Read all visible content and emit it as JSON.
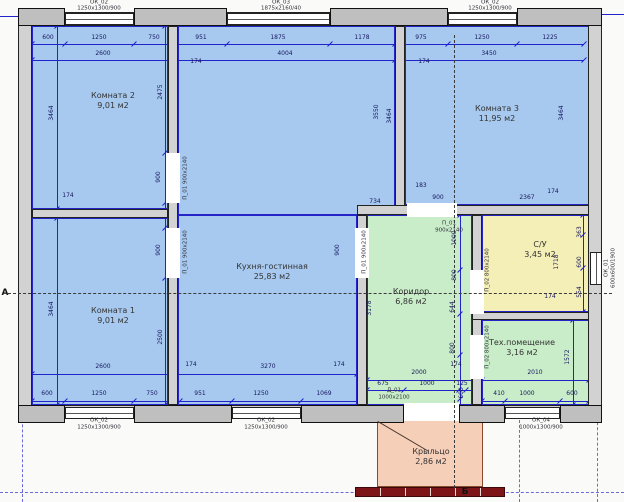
{
  "title": "Поэтажный план дома",
  "colors": {
    "blue": "#a7c9ef",
    "green": "#c9edc9",
    "yellow": "#f4efb6",
    "porch": "#f6cfb8",
    "wall": "#d2d2d2",
    "accent_line": "#2323cc",
    "steps": "#7d1518"
  },
  "plan": {
    "rooms": [
      {
        "id": "komnata-2",
        "name": "Комната 2",
        "area": "9,01 м2",
        "color": "blue",
        "lx": 113,
        "ly": 101,
        "rects": [
          [
            32,
            26,
            136,
            183
          ]
        ]
      },
      {
        "id": "komnata-1",
        "name": "Комната 1",
        "area": "9,01 м2",
        "color": "blue",
        "lx": 113,
        "ly": 316,
        "rects": [
          [
            32,
            218,
            136,
            187
          ]
        ]
      },
      {
        "id": "kuhnya-gostinnaya",
        "name": "Кухня-гостинная",
        "area": "25,83 м2",
        "color": "blue",
        "lx": 272,
        "ly": 272,
        "rects": [
          [
            178,
            26,
            217,
            189
          ],
          [
            178,
            215,
            179,
            190
          ]
        ]
      },
      {
        "id": "komnata-3",
        "name": "Комната 3",
        "area": "11,95 м2",
        "color": "blue",
        "lx": 497,
        "ly": 114,
        "rects": [
          [
            405,
            26,
            184,
            179
          ]
        ]
      },
      {
        "id": "koridor",
        "name": "Коридор",
        "area": "6,86 м2",
        "color": "green",
        "lx": 411,
        "ly": 297,
        "rects": [
          [
            367,
            215,
            105,
            190
          ]
        ]
      },
      {
        "id": "su",
        "name": "С/У",
        "area": "3,45 м2",
        "color": "yellow",
        "lx": 540,
        "ly": 250,
        "rects": [
          [
            482,
            215,
            107,
            97
          ]
        ]
      },
      {
        "id": "tehpomeschenie",
        "name": "Тех.помещение",
        "area": "3,16 м2",
        "color": "green",
        "lx": 522,
        "ly": 348,
        "rects": [
          [
            482,
            320,
            107,
            85
          ]
        ]
      },
      {
        "id": "krylco",
        "name": "Крыльцо",
        "area": "2,86 м2",
        "color": "porch",
        "lx": 431,
        "ly": 457,
        "rects": [
          [
            377,
            419,
            106,
            68
          ]
        ]
      }
    ],
    "walls": [
      [
        18,
        12,
        584,
        14
      ],
      [
        18,
        405,
        584,
        14
      ],
      [
        18,
        12,
        14,
        407
      ],
      [
        588,
        12,
        14,
        407
      ],
      [
        168,
        26,
        10,
        379
      ],
      [
        32,
        209,
        136,
        9
      ],
      [
        395,
        26,
        10,
        189
      ],
      [
        357,
        205,
        232,
        10
      ],
      [
        357,
        215,
        10,
        190
      ],
      [
        472,
        215,
        10,
        190
      ],
      [
        472,
        312,
        117,
        8
      ]
    ],
    "piers": [
      [
        18,
        8,
        47,
        18
      ],
      [
        134,
        8,
        93,
        18
      ],
      [
        330,
        8,
        118,
        18
      ],
      [
        517,
        8,
        85,
        18
      ],
      [
        18,
        405,
        47,
        18
      ],
      [
        134,
        405,
        98,
        18
      ],
      [
        301,
        405,
        103,
        18
      ],
      [
        459,
        405,
        46,
        18
      ],
      [
        560,
        405,
        42,
        18
      ]
    ],
    "gaps": [
      [
        166,
        153,
        14,
        50
      ],
      [
        166,
        228,
        14,
        50
      ],
      [
        407,
        203,
        50,
        14
      ],
      [
        355,
        228,
        14,
        50
      ],
      [
        470,
        270,
        14,
        44
      ],
      [
        470,
        335,
        14,
        44
      ],
      [
        404,
        403,
        55,
        18
      ]
    ],
    "windows": [
      {
        "r": [
          65,
          13,
          69,
          12
        ],
        "o": "h"
      },
      {
        "r": [
          227,
          13,
          103,
          12
        ],
        "o": "h"
      },
      {
        "r": [
          448,
          13,
          69,
          12
        ],
        "o": "h"
      },
      {
        "r": [
          65,
          407,
          69,
          12
        ],
        "o": "h"
      },
      {
        "r": [
          232,
          407,
          69,
          12
        ],
        "o": "h"
      },
      {
        "r": [
          505,
          407,
          55,
          12
        ],
        "o": "h"
      },
      {
        "r": [
          590,
          252,
          12,
          33
        ],
        "o": "v"
      }
    ],
    "dimlines": [
      {
        "o": "h",
        "x": 32,
        "y": 44,
        "len": 552,
        "ticks": [
          32,
          65,
          134,
          175,
          227,
          330,
          395,
          448,
          517,
          584
        ]
      },
      {
        "o": "h",
        "x": 32,
        "y": 60,
        "len": 552,
        "ticks": [
          32,
          175,
          395,
          584
        ]
      },
      {
        "o": "h",
        "x": 32,
        "y": 374,
        "len": 325,
        "ticks": [
          32,
          175,
          357
        ]
      },
      {
        "o": "h",
        "x": 32,
        "y": 401,
        "len": 328,
        "ticks": [
          32,
          65,
          134,
          175,
          180,
          232,
          301,
          360
        ]
      },
      {
        "o": "h",
        "x": 360,
        "y": 380,
        "len": 120,
        "ticks": [
          367,
          477
        ]
      },
      {
        "o": "h",
        "x": 367,
        "y": 390,
        "len": 105,
        "ticks": [
          367,
          404,
          459,
          466
        ]
      },
      {
        "o": "h",
        "x": 482,
        "y": 380,
        "len": 107,
        "ticks": [
          482,
          589
        ]
      },
      {
        "o": "h",
        "x": 482,
        "y": 401,
        "len": 107,
        "ticks": [
          482,
          505,
          560,
          589
        ]
      },
      {
        "o": "v",
        "x": 57,
        "y": 26,
        "len": 379,
        "ticks": [
          26,
          209,
          218,
          405
        ]
      },
      {
        "o": "v",
        "x": 165,
        "y": 26,
        "len": 379,
        "ticks": [
          26,
          153,
          203,
          228,
          278,
          405
        ]
      },
      {
        "o": "v",
        "x": 460,
        "y": 215,
        "len": 190,
        "ticks": [
          215,
          270,
          314,
          355,
          399
        ]
      },
      {
        "o": "v",
        "x": 583,
        "y": 215,
        "len": 97,
        "ticks": [
          215,
          235,
          268,
          312
        ]
      },
      {
        "o": "v",
        "x": 573,
        "y": 320,
        "len": 85,
        "ticks": [
          320,
          405
        ]
      }
    ],
    "labels": [
      {
        "t": "600",
        "x": 48,
        "y": 38,
        "c": "d"
      },
      {
        "t": "1250",
        "x": 99,
        "y": 38,
        "c": "d"
      },
      {
        "t": "750",
        "x": 154,
        "y": 38,
        "c": "d"
      },
      {
        "t": "951",
        "x": 201,
        "y": 38,
        "c": "d"
      },
      {
        "t": "1875",
        "x": 278,
        "y": 38,
        "c": "d"
      },
      {
        "t": "1178",
        "x": 362,
        "y": 38,
        "c": "d"
      },
      {
        "t": "975",
        "x": 421,
        "y": 38,
        "c": "d"
      },
      {
        "t": "1250",
        "x": 482,
        "y": 38,
        "c": "d"
      },
      {
        "t": "1225",
        "x": 550,
        "y": 38,
        "c": "d"
      },
      {
        "t": "2600",
        "x": 103,
        "y": 54,
        "c": "d"
      },
      {
        "t": "4004",
        "x": 285,
        "y": 54,
        "c": "d"
      },
      {
        "t": "3450",
        "x": 489,
        "y": 54,
        "c": "d"
      },
      {
        "t": "2600",
        "x": 103,
        "y": 367,
        "c": "d"
      },
      {
        "t": "3270",
        "x": 268,
        "y": 367,
        "c": "d"
      },
      {
        "t": "2000",
        "x": 419,
        "y": 373,
        "c": "d"
      },
      {
        "t": "2010",
        "x": 535,
        "y": 373,
        "c": "d"
      },
      {
        "t": "675",
        "x": 383,
        "y": 384,
        "c": "d"
      },
      {
        "t": "1000",
        "x": 427,
        "y": 384,
        "c": "d"
      },
      {
        "t": "125",
        "x": 462,
        "y": 384,
        "c": "d"
      },
      {
        "t": "600",
        "x": 47,
        "y": 394,
        "c": "d"
      },
      {
        "t": "1250",
        "x": 99,
        "y": 394,
        "c": "d"
      },
      {
        "t": "750",
        "x": 152,
        "y": 394,
        "c": "d"
      },
      {
        "t": "951",
        "x": 200,
        "y": 394,
        "c": "d"
      },
      {
        "t": "1250",
        "x": 261,
        "y": 394,
        "c": "d"
      },
      {
        "t": "1069",
        "x": 324,
        "y": 394,
        "c": "d"
      },
      {
        "t": "410",
        "x": 499,
        "y": 394,
        "c": "d"
      },
      {
        "t": "1000",
        "x": 527,
        "y": 394,
        "c": "d"
      },
      {
        "t": "600",
        "x": 572,
        "y": 394,
        "c": "d"
      },
      {
        "t": "174",
        "x": 196,
        "y": 62,
        "c": "d"
      },
      {
        "t": "174",
        "x": 424,
        "y": 62,
        "c": "d"
      },
      {
        "t": "174",
        "x": 68,
        "y": 196,
        "c": "d"
      },
      {
        "t": "174",
        "x": 553,
        "y": 192,
        "c": "d"
      },
      {
        "t": "174",
        "x": 550,
        "y": 297,
        "c": "d"
      },
      {
        "t": "174",
        "x": 191,
        "y": 365,
        "c": "d"
      },
      {
        "t": "174",
        "x": 339,
        "y": 365,
        "c": "d"
      },
      {
        "t": "174",
        "x": 456,
        "y": 365,
        "c": "d"
      },
      {
        "t": "183",
        "x": 421,
        "y": 186,
        "c": "d"
      },
      {
        "t": "900",
        "x": 438,
        "y": 198,
        "c": "d"
      },
      {
        "t": "2367",
        "x": 527,
        "y": 198,
        "c": "d"
      },
      {
        "t": "734",
        "x": 375,
        "y": 202,
        "c": "d"
      },
      {
        "t": "3464",
        "x": 52,
        "y": 113,
        "c": "d",
        "r": 1
      },
      {
        "t": "3464",
        "x": 52,
        "y": 309,
        "c": "d",
        "r": 1
      },
      {
        "t": "2475",
        "x": 161,
        "y": 92,
        "c": "d",
        "r": 1
      },
      {
        "t": "2500",
        "x": 161,
        "y": 337,
        "c": "d",
        "r": 1
      },
      {
        "t": "900",
        "x": 159,
        "y": 177,
        "c": "d",
        "r": 1
      },
      {
        "t": "900",
        "x": 159,
        "y": 250,
        "c": "d",
        "r": 1
      },
      {
        "t": "900",
        "x": 338,
        "y": 250,
        "c": "d",
        "r": 1
      },
      {
        "t": "3550",
        "x": 377,
        "y": 112,
        "c": "d",
        "r": 1
      },
      {
        "t": "3464",
        "x": 390,
        "y": 116,
        "c": "d",
        "r": 1
      },
      {
        "t": "3464",
        "x": 562,
        "y": 113,
        "c": "d",
        "r": 1
      },
      {
        "t": "3178",
        "x": 370,
        "y": 308,
        "c": "d",
        "r": 1
      },
      {
        "t": "1000",
        "x": 455,
        "y": 238,
        "c": "d",
        "r": 1
      },
      {
        "t": "800",
        "x": 455,
        "y": 275,
        "c": "d",
        "r": 1
      },
      {
        "t": "644",
        "x": 453,
        "y": 307,
        "c": "d",
        "r": 1
      },
      {
        "t": "800",
        "x": 453,
        "y": 348,
        "c": "d",
        "r": 1
      },
      {
        "t": "600",
        "x": 462,
        "y": 393,
        "c": "d",
        "r": 1
      },
      {
        "t": "1718",
        "x": 557,
        "y": 262,
        "c": "d",
        "r": 1
      },
      {
        "t": "363",
        "x": 580,
        "y": 232,
        "c": "d",
        "r": 1
      },
      {
        "t": "600",
        "x": 580,
        "y": 262,
        "c": "d",
        "r": 1
      },
      {
        "t": "554",
        "x": 580,
        "y": 292,
        "c": "d",
        "r": 1
      },
      {
        "t": "1572",
        "x": 568,
        "y": 357,
        "c": "d",
        "r": 1
      },
      {
        "t": "ОК_02",
        "x": 99,
        "y": 3,
        "c": "w"
      },
      {
        "t": "1250х1300/900",
        "x": 99,
        "y": 9,
        "c": "w"
      },
      {
        "t": "ОК_03",
        "x": 281,
        "y": 3,
        "c": "w"
      },
      {
        "t": "1875х2160/40",
        "x": 281,
        "y": 9,
        "c": "w"
      },
      {
        "t": "ОК_02",
        "x": 490,
        "y": 3,
        "c": "w"
      },
      {
        "t": "1250х1300/900",
        "x": 490,
        "y": 9,
        "c": "w"
      },
      {
        "t": "ОК_02",
        "x": 99,
        "y": 421,
        "c": "w"
      },
      {
        "t": "1250х1300/900",
        "x": 99,
        "y": 428,
        "c": "w"
      },
      {
        "t": "ОК_02",
        "x": 266,
        "y": 421,
        "c": "w"
      },
      {
        "t": "1250х1300/900",
        "x": 266,
        "y": 428,
        "c": "w"
      },
      {
        "t": "ОК_04",
        "x": 541,
        "y": 421,
        "c": "w"
      },
      {
        "t": "1000х1300/900",
        "x": 541,
        "y": 428,
        "c": "w"
      },
      {
        "t": "Д_01",
        "x": 394,
        "y": 391,
        "c": "w"
      },
      {
        "t": "1000х2100",
        "x": 394,
        "y": 398,
        "c": "w"
      },
      {
        "t": "П_01",
        "x": 449,
        "y": 224,
        "c": "w"
      },
      {
        "t": "900х2140",
        "x": 449,
        "y": 231,
        "c": "w"
      },
      {
        "t": "П_01 900х2140",
        "x": 186,
        "y": 178,
        "c": "w",
        "r": 1
      },
      {
        "t": "П_01 900х2140",
        "x": 186,
        "y": 252,
        "c": "w",
        "r": 1
      },
      {
        "t": "П_01 900х2140",
        "x": 365,
        "y": 252,
        "c": "w",
        "r": 1
      },
      {
        "t": "П_02 800х2140",
        "x": 488,
        "y": 270,
        "c": "w",
        "r": 1
      },
      {
        "t": "П_02 800х2140",
        "x": 488,
        "y": 347,
        "c": "w",
        "r": 1
      },
      {
        "t": "ОК_01",
        "x": 607,
        "y": 268,
        "c": "w",
        "r": 1
      },
      {
        "t": "600х600/1900",
        "x": 614,
        "y": 268,
        "c": "w",
        "r": 1
      }
    ],
    "sections": [
      {
        "o": "h",
        "x": 8,
        "y": 293,
        "len": 604
      },
      {
        "o": "v",
        "x": 454,
        "y": 35,
        "len": 453
      }
    ],
    "markers": [
      {
        "t": "А",
        "x": 5,
        "y": 293
      },
      {
        "t": "Б",
        "x": 465,
        "y": 492
      }
    ],
    "boundaries": [
      {
        "o": "h",
        "x": 0,
        "y": 492,
        "len": 624
      },
      {
        "o": "v",
        "x": 22,
        "y": 325,
        "len": 177
      },
      {
        "o": "v",
        "x": 519,
        "y": 420,
        "len": 82
      },
      {
        "o": "v",
        "x": 597,
        "y": 417,
        "len": 85
      }
    ],
    "axis_ext": [
      [
        0,
        16,
        20
      ],
      [
        602,
        14,
        22
      ]
    ],
    "porch": {
      "diag": {
        "x": 378,
        "y": 421,
        "len": 59,
        "ang": 30.5
      },
      "steps": [
        355,
        487,
        150,
        10
      ],
      "stripes": [
        25,
        50,
        75,
        100,
        125
      ]
    }
  }
}
